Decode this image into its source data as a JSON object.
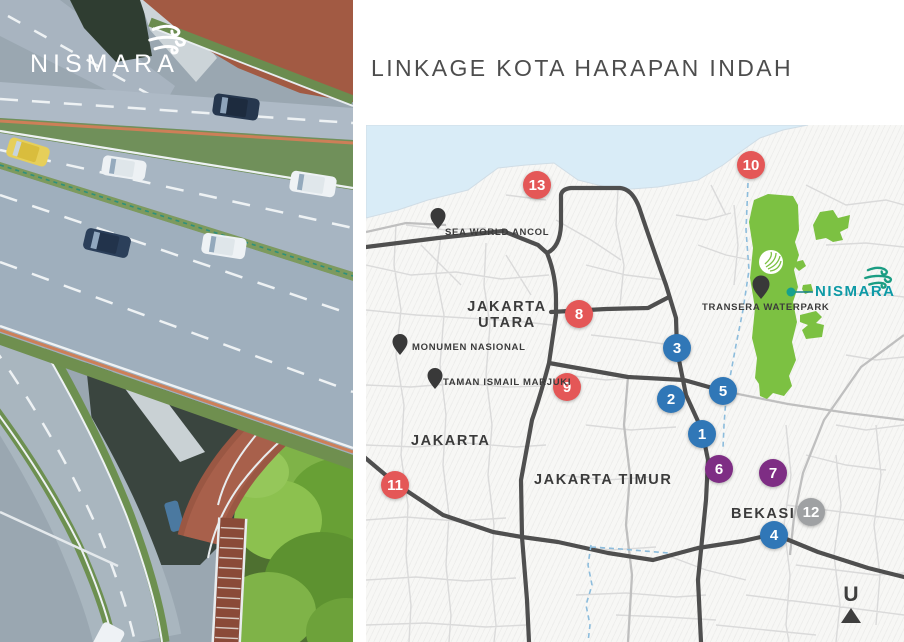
{
  "slide": {
    "title": "LINKAGE KOTA HARAPAN INDAH"
  },
  "brand": {
    "name": "NISMARA",
    "logo_icon": "wind-swirl-icon"
  },
  "map": {
    "north_label": "U",
    "callout": {
      "label": "NISMARA",
      "dot_icon": "location-dot-icon"
    },
    "pois": {
      "sea_world_ancol": "SEA WORLD ANCOL",
      "monumen_nasional": "MONUMEN NASIONAL",
      "taman_ismail_marjuki": "TAMAN ISMAIL MARJUKI",
      "transera_waterpark": "TRANSERA WATERPARK"
    },
    "regions": {
      "jakarta_utara_line1": "JAKARTA",
      "jakarta_utara_line2": "UTARA",
      "jakarta": "JAKARTA",
      "jakarta_timur": "JAKARTA TIMUR",
      "bekasi": "BEKASI"
    },
    "markers": {
      "m1": {
        "label": "1",
        "color": "blue"
      },
      "m2": {
        "label": "2",
        "color": "blue"
      },
      "m3": {
        "label": "3",
        "color": "blue"
      },
      "m4": {
        "label": "4",
        "color": "blue"
      },
      "m5": {
        "label": "5",
        "color": "blue"
      },
      "m6": {
        "label": "6",
        "color": "purple"
      },
      "m7": {
        "label": "7",
        "color": "purple"
      },
      "m8": {
        "label": "8",
        "color": "red"
      },
      "m9": {
        "label": "9",
        "color": "red"
      },
      "m10": {
        "label": "10",
        "color": "red"
      },
      "m11": {
        "label": "11",
        "color": "red"
      },
      "m12": {
        "label": "12",
        "color": "gray"
      },
      "m13": {
        "label": "13",
        "color": "red"
      }
    },
    "colors": {
      "marker_blue": "#3077b7",
      "marker_red": "#e45757",
      "marker_purple": "#7e2d84",
      "marker_gray": "#9fa1a3",
      "development_green": "#7cc142",
      "sea_blue": "#d9ecf7",
      "brand_teal": "#0d9aa6",
      "logo_green": "#1b9d83",
      "major_road": "#4f4f4f"
    }
  }
}
